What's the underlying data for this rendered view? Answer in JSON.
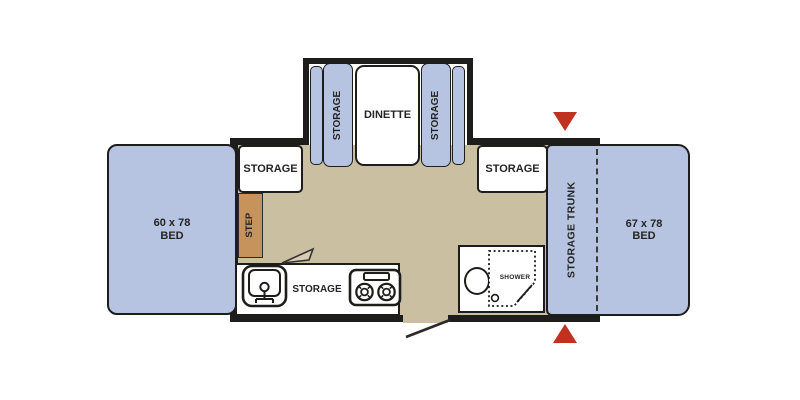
{
  "diagram": {
    "type": "travel-trailer floorplan",
    "beds": {
      "left": {
        "line1": "60 x 78",
        "line2": "BED"
      },
      "right": {
        "line1": "67 x 78",
        "line2": "BED"
      }
    },
    "dinette": {
      "label": "DINETTE",
      "left_seat": "STORAGE",
      "right_seat": "STORAGE"
    },
    "storage": {
      "left_cabinet": "STORAGE",
      "right_cabinet": "STORAGE",
      "counter": "STORAGE",
      "trunk": "STORAGE TRUNK"
    },
    "step": {
      "label": "STEP"
    },
    "bathroom": {
      "shower": "SHOWER"
    },
    "colors": {
      "bed_blue": "#b6c4e1",
      "floor_tan": "#cbbfa2",
      "step_orange": "#c6935c",
      "wall_black": "#1d1d1b",
      "arrow_red": "#c1311f",
      "fixture_white": "#ffffff"
    }
  }
}
